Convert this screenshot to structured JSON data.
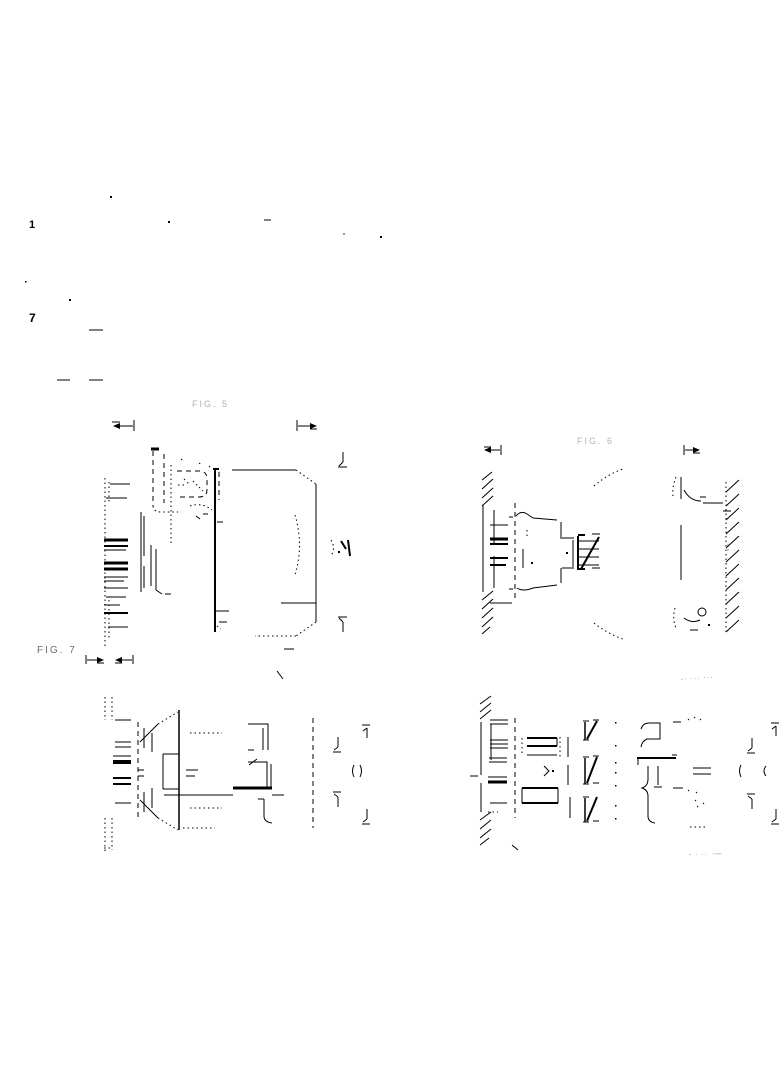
{
  "colors": {
    "paper": "#ffffff",
    "ink": "#000000",
    "faint_ink": "#b3b3b3",
    "fragment_ink": "#8c8c8c"
  },
  "figures": {
    "top_left": {
      "label": "FIG. 5"
    },
    "top_right": {
      "label": "FIG. 6"
    },
    "bottom_left": {
      "label": "FIG. 7"
    },
    "bottom_right": {
      "fragment_top": "-· ··· ··-",
      "fragment_bottom": "- · ·· ·—"
    }
  },
  "margin": {
    "glyph_top": "1",
    "glyph_mid": "7"
  }
}
